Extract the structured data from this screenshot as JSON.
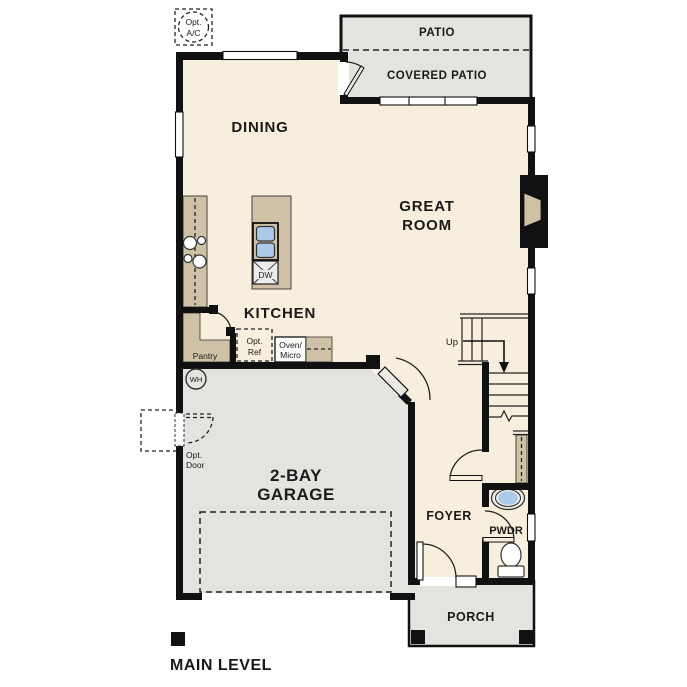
{
  "plan": {
    "title": "MAIN LEVEL",
    "labels": {
      "opt_ac_1": "Opt.",
      "opt_ac_2": "A/C",
      "patio": "PATIO",
      "covered_patio": "COVERED PATIO",
      "dining": "DINING",
      "great_room_1": "GREAT",
      "great_room_2": "ROOM",
      "kitchen": "KITCHEN",
      "pantry": "Pantry",
      "opt_ref_1": "Opt.",
      "opt_ref_2": "Ref",
      "oven_micro_1": "Oven/",
      "oven_micro_2": "Micro",
      "dw": "DW",
      "wh": "WH",
      "up": "Up",
      "opt_door_1": "Opt.",
      "opt_door_2": "Door",
      "garage_1": "2-BAY",
      "garage_2": "GARAGE",
      "foyer": "FOYER",
      "pwdr": "PWDR",
      "porch": "PORCH"
    }
  },
  "colors": {
    "interior": "#f8eedd",
    "outdoor": "#e4e3e0",
    "counter": "#cec1a5",
    "sink_blue": "#abcae9",
    "appliance": "#ececea",
    "wall": "#111111"
  }
}
